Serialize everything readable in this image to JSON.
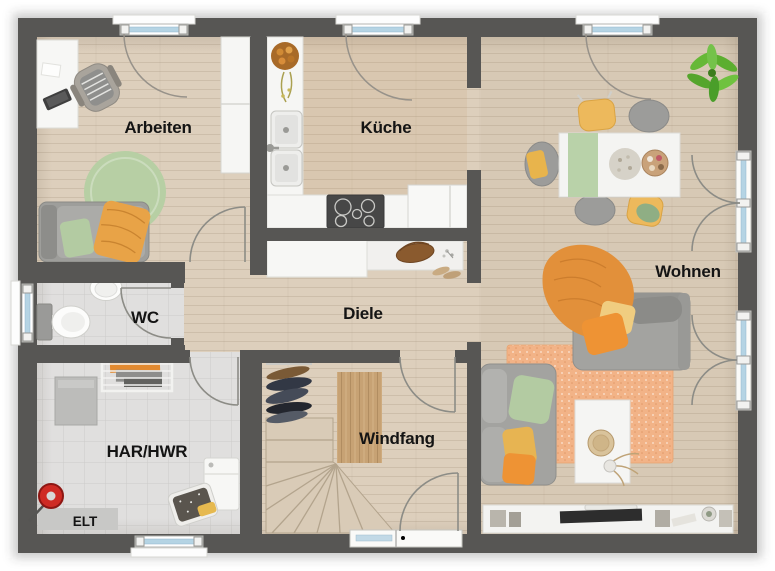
{
  "rooms": [
    {
      "id": "arbeiten",
      "label": "Arbeiten"
    },
    {
      "id": "kueche",
      "label": "Küche"
    },
    {
      "id": "wohnen",
      "label": "Wohnen"
    },
    {
      "id": "wc",
      "label": "WC"
    },
    {
      "id": "diele",
      "label": "Diele"
    },
    {
      "id": "windfang",
      "label": "Windfang"
    },
    {
      "id": "har-hwr",
      "label": "HAR/HWR"
    },
    {
      "id": "elt",
      "label": "ELT"
    }
  ],
  "palette": {
    "wall": "#575654",
    "wood_floor": "#ddcfbc",
    "kitchen_floor_tint": "#d9c5ac",
    "tile_floor": "#e0dfde",
    "window_glass": "#b5d4e4",
    "accent_orange": "#ec9737",
    "accent_yellow": "#eeba5e",
    "accent_green": "#b2cba1",
    "sofa_gray": "#a2a29f",
    "furniture_white": "#f6f6f4",
    "stair_wood": "#d9cbb7",
    "doormat_wood": "#c7a274",
    "rug_orange": "#f2b387",
    "rug_green": "#b7cfa4",
    "label_color": "#141414"
  },
  "fixtures": {
    "windows": [
      "window-arbeiten-top",
      "window-kueche-top",
      "window-wohnen-top",
      "window-wc-left",
      "window-har-bottom"
    ],
    "doors": [
      "entrance-door",
      "terrace-door-upper",
      "terrace-door-lower",
      "door-arbeiten",
      "door-wc",
      "door-har-hwr",
      "door-windfang"
    ],
    "stairs": "winder-staircase"
  }
}
